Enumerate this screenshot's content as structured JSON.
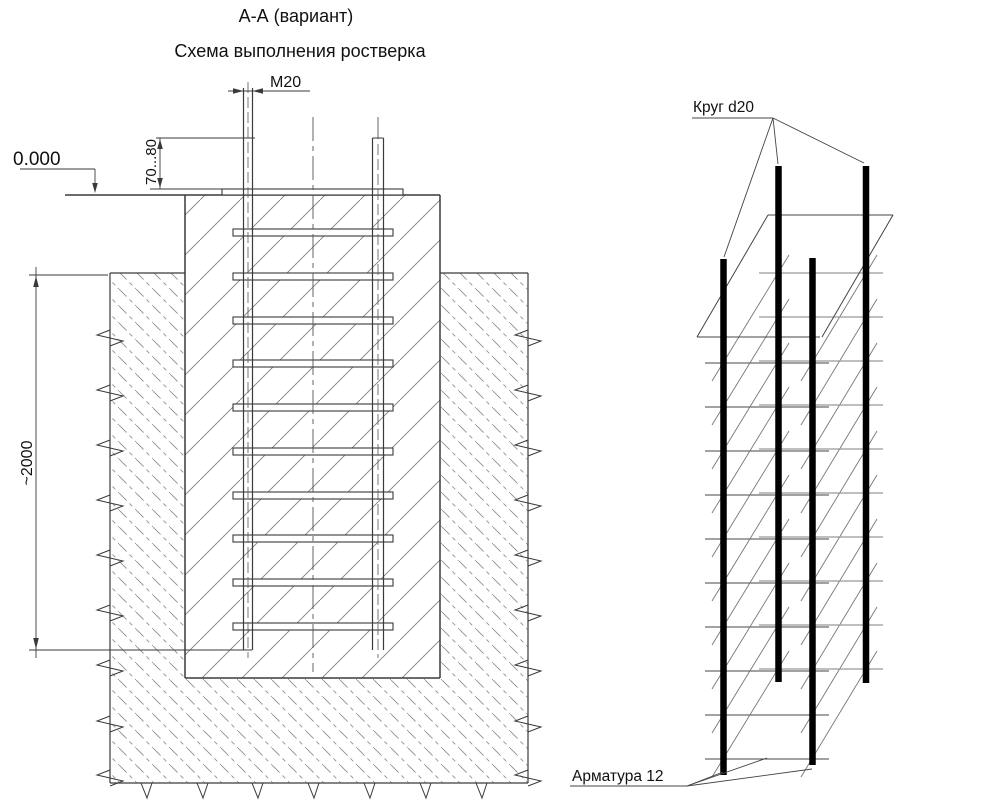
{
  "titles": {
    "section": "А-А (вариант)",
    "scheme": "Схема выполнения ростверка"
  },
  "dimensions": {
    "elevation": "0.000",
    "anchor_thread": "М20",
    "bolt_protrusion": "70...80",
    "embedment_depth": "~2000"
  },
  "labels": {
    "round_bar": "Круг d20",
    "rebar": "Арматура 12"
  },
  "colors": {
    "line": "#3a3a3a",
    "hatch": "#8a8a8a",
    "bar": "#000000",
    "background": "#ffffff"
  }
}
